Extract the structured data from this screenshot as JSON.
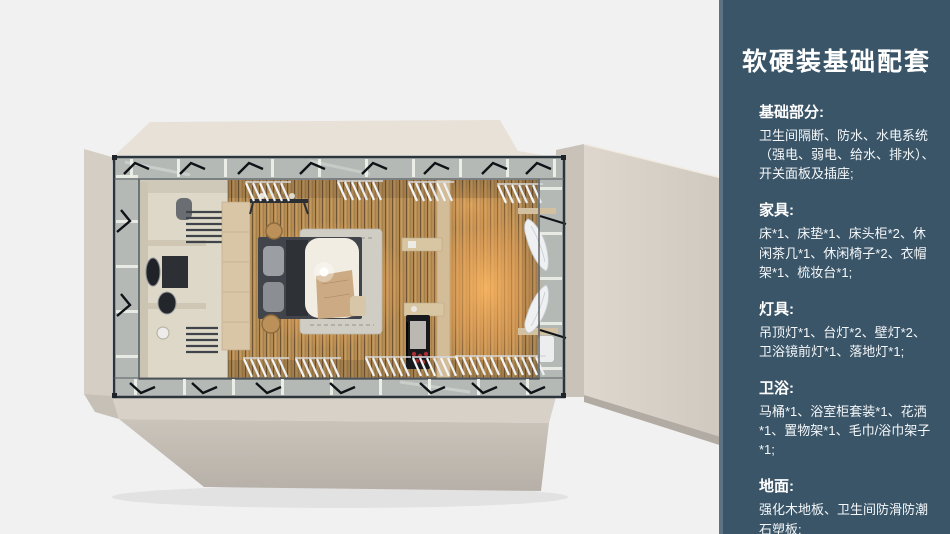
{
  "layout": {
    "width": 950,
    "height": 534
  },
  "render": {
    "alt": "3D top-down rendering of a prefab guest room: bathroom at left, double bed at center, shelving and curtained window wall at right",
    "palette": {
      "page_background": "#f1f1f2",
      "shell_beige": "#d8d1c8",
      "roof_beige": "#e8e1d8",
      "wood_floor": "#b68c54",
      "warm_glow": "#ffb963",
      "glass_band": "#b4b9b5",
      "frame_dark": "#2c343c",
      "bedding_white": "#f1ede3",
      "rug_gray": "#d0cdc4"
    }
  },
  "panel": {
    "background": "#3a5568",
    "edge_strip": "#5b7383",
    "text_color": "#ffffff",
    "title": "软硬装基础配套",
    "sections": [
      {
        "heading": "基础部分:",
        "body": "卫生间隔断、防水、水电系统（强电、弱电、给水、排水）、开关面板及插座;"
      },
      {
        "heading": "家具:",
        "body": "床*1、床垫*1、床头柜*2、休闲茶几*1、休闲椅子*2、衣帽架*1、梳妆台*1;"
      },
      {
        "heading": "灯具:",
        "body": "吊顶灯*1、台灯*2、壁灯*2、卫浴镜前灯*1、落地灯*1;"
      },
      {
        "heading": "卫浴:",
        "body": "马桶*1、浴室柜套装*1、花洒*1、置物架*1、毛巾/浴巾架子*1;"
      },
      {
        "heading": "地面:",
        "body": "强化木地板、卫生间防滑防潮石塑板;"
      }
    ]
  }
}
